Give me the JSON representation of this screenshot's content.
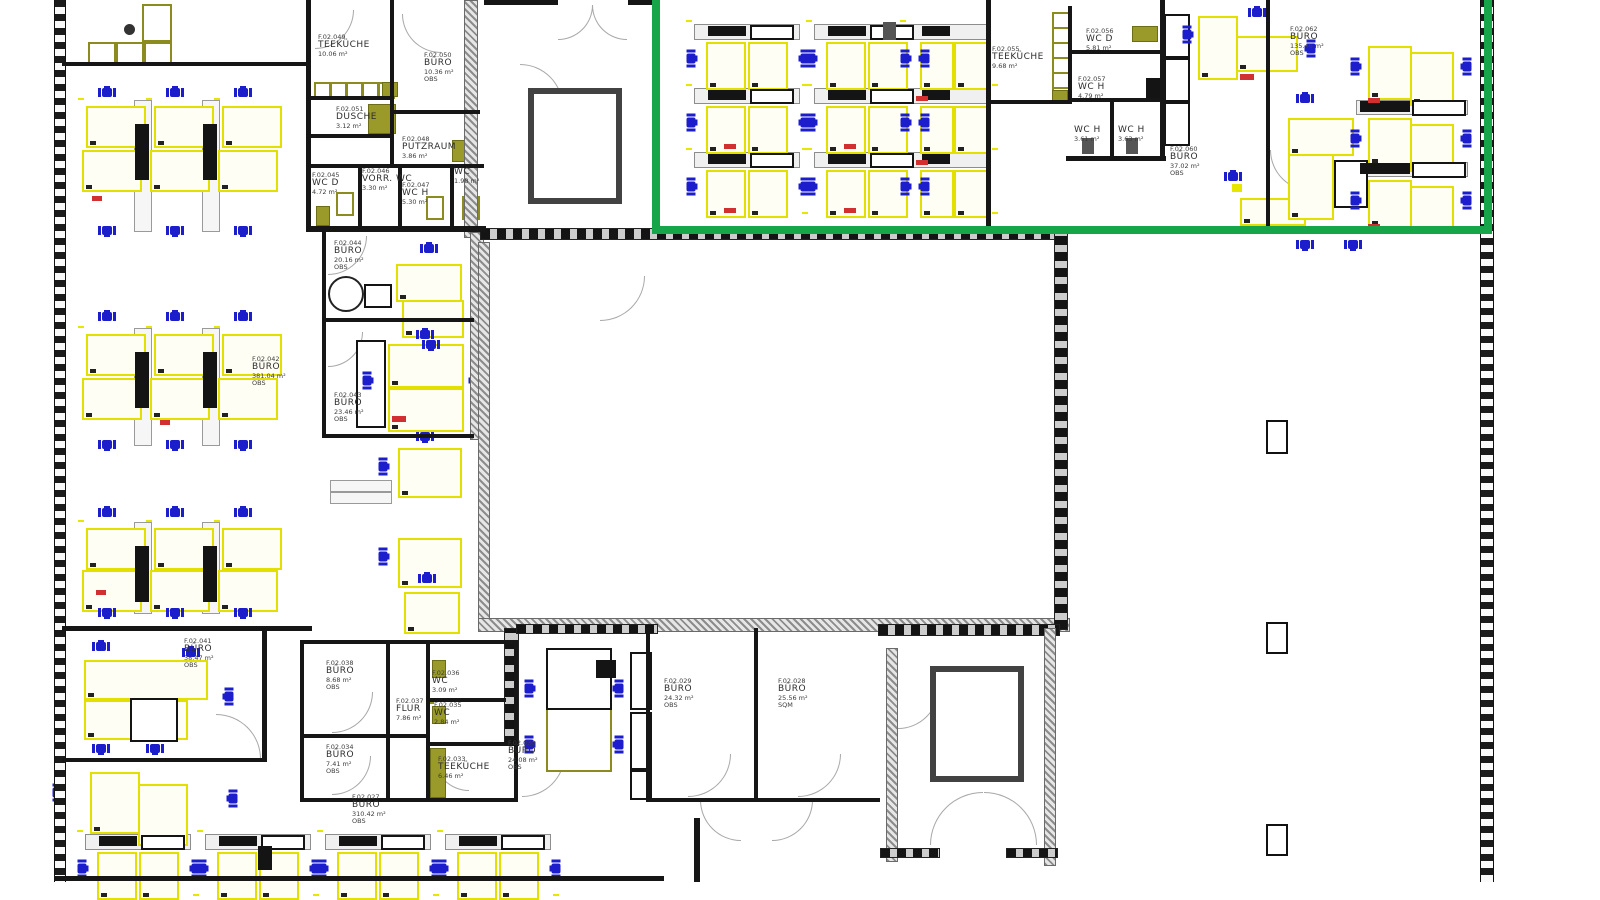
{
  "title": "Bürogebäude Ebene 02 – Möblierungsplan (CAD)",
  "highlight": {
    "color": "#17a54a",
    "meaning": "selected-zone-rectangle"
  },
  "colors": {
    "wall": "#161616",
    "desk": "#e3df00",
    "chair": "#1d1ecb",
    "counter": "#8b8b1f",
    "accent_red": "#d23030"
  },
  "rooms": [
    {
      "id": "teekueche_nw",
      "code": "F.02.049",
      "name": "TEEKÜCHE",
      "area": "10.06 m²",
      "tag": ""
    },
    {
      "id": "buero_1036",
      "code": "F.02.050",
      "name": "BÜRO",
      "area": "10.36 m²",
      "tag": "OBS"
    },
    {
      "id": "dusche",
      "code": "F.02.051",
      "name": "DUSCHE",
      "area": "3.12 m²",
      "tag": ""
    },
    {
      "id": "putzraum",
      "code": "F.02.048",
      "name": "PUTZRAUM",
      "area": "3.86 m²",
      "tag": ""
    },
    {
      "id": "wc_d_nw",
      "code": "F.02.045",
      "name": "WC D",
      "area": "4.72 m²",
      "tag": ""
    },
    {
      "id": "vorr_wc",
      "code": "F.02.046",
      "name": "VORR. WC",
      "area": "3.30 m²",
      "tag": ""
    },
    {
      "id": "wc_h_nw",
      "code": "F.02.047",
      "name": "WC H",
      "area": "5.30 m²",
      "tag": ""
    },
    {
      "id": "wc_nw",
      "code": "",
      "name": "WC",
      "area": "1.98 m²",
      "tag": ""
    },
    {
      "id": "buero_2016",
      "code": "F.02.044",
      "name": "BÜRO",
      "area": "20.16 m²",
      "tag": "OBS"
    },
    {
      "id": "buero_2346",
      "code": "F.02.043",
      "name": "BÜRO",
      "area": "23.46 m²",
      "tag": "OBS"
    },
    {
      "id": "buero_381",
      "code": "F.02.042",
      "name": "BÜRO",
      "area": "381.04 m²",
      "tag": "OBS"
    },
    {
      "id": "buero_3847",
      "code": "F.02.041",
      "name": "BÜRO",
      "area": "38.47 m²",
      "tag": "OBS"
    },
    {
      "id": "buero_868",
      "code": "F.02.038",
      "name": "BÜRO",
      "area": "8.68 m²",
      "tag": "OBS"
    },
    {
      "id": "flur",
      "code": "F.02.037",
      "name": "FLUR",
      "area": "7.86 m²",
      "tag": ""
    },
    {
      "id": "wc_309",
      "code": "F.02.036",
      "name": "WC",
      "area": "3.09 m²",
      "tag": ""
    },
    {
      "id": "wc_284",
      "code": "F.02.035",
      "name": "WC",
      "area": "2.84 m²",
      "tag": ""
    },
    {
      "id": "buero_741",
      "code": "F.02.034",
      "name": "BÜRO",
      "area": "7.41 m²",
      "tag": "OBS"
    },
    {
      "id": "teekueche_s",
      "code": "F.02.033",
      "name": "TEEKÜCHE",
      "area": "6.46 m²",
      "tag": ""
    },
    {
      "id": "buero_2408",
      "code": "F.02.030",
      "name": "BÜRO",
      "area": "24.08 m²",
      "tag": "OBS"
    },
    {
      "id": "buero_2432",
      "code": "F.02.029",
      "name": "BÜRO",
      "area": "24.32 m²",
      "tag": "OBS"
    },
    {
      "id": "buero_2556",
      "code": "F.02.028",
      "name": "BÜRO",
      "area": "25.56 m²",
      "tag": "SQM"
    },
    {
      "id": "buero_310",
      "code": "F.02.027",
      "name": "BÜRO",
      "area": "310.42 m²",
      "tag": "OBS"
    },
    {
      "id": "teekueche_ne",
      "code": "F.02.055",
      "name": "TEEKÜCHE",
      "area": "9.68 m²",
      "tag": ""
    },
    {
      "id": "wc_d_ne",
      "code": "F.02.056",
      "name": "WC D",
      "area": "5.81 m²",
      "tag": ""
    },
    {
      "id": "wc_h_ne",
      "code": "F.02.057",
      "name": "WC H",
      "area": "4.79 m²",
      "tag": ""
    },
    {
      "id": "wc_h_ne2",
      "code": "",
      "name": "WC H",
      "area": "3.61 m²",
      "tag": ""
    },
    {
      "id": "wc_h_ne3",
      "code": "",
      "name": "WC H",
      "area": "3.63 m²",
      "tag": ""
    },
    {
      "id": "buero_3702",
      "code": "F.02.060",
      "name": "BÜRO",
      "area": "37.02 m²",
      "tag": "OBS"
    },
    {
      "id": "buero_135",
      "code": "F.02.062",
      "name": "BÜRO",
      "area": "135.46 m²",
      "tag": "OBS"
    }
  ]
}
